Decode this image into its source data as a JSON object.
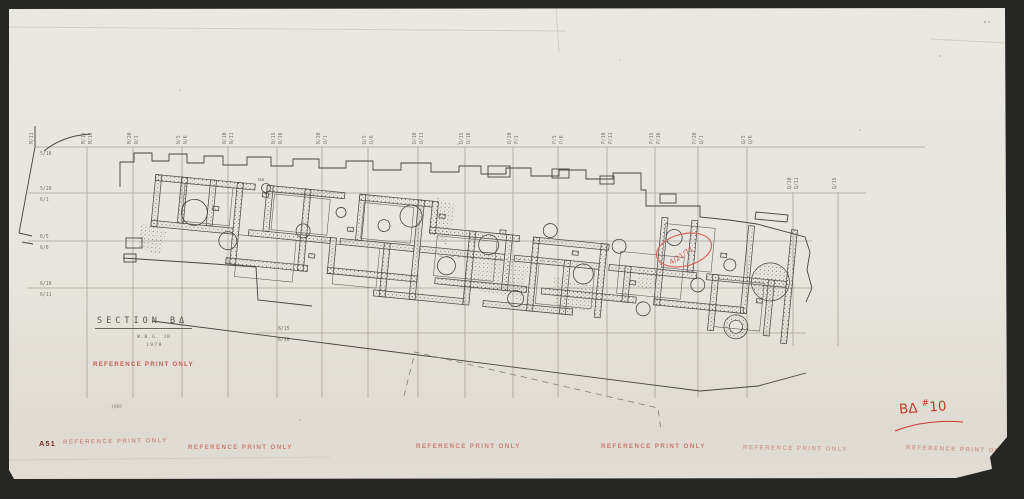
{
  "scan": {
    "background": "#262625",
    "paper_color": "#e9e6e0"
  },
  "grid": {
    "color": "#a8a39a",
    "label_color": "#76726a",
    "edge_column": {
      "x": 35,
      "label": "M/11"
    },
    "columns": [
      {
        "x": 87,
        "labels": [
          "M/15",
          "M/16"
        ]
      },
      {
        "x": 133,
        "labels": [
          "M/20",
          "N/1"
        ]
      },
      {
        "x": 182,
        "labels": [
          "N/5",
          "N/6"
        ]
      },
      {
        "x": 228,
        "labels": [
          "N/10",
          "N/11"
        ]
      },
      {
        "x": 277,
        "labels": [
          "N/15",
          "N/16"
        ]
      },
      {
        "x": 322,
        "labels": [
          "N/20",
          "O/1"
        ]
      },
      {
        "x": 368,
        "labels": [
          "O/5",
          "O/6"
        ]
      },
      {
        "x": 418,
        "labels": [
          "O/10",
          "O/11"
        ]
      },
      {
        "x": 465,
        "labels": [
          "O/15",
          "O/16"
        ]
      },
      {
        "x": 513,
        "labels": [
          "O/20",
          "P/1"
        ]
      },
      {
        "x": 558,
        "labels": [
          "P/5",
          "P/6"
        ]
      },
      {
        "x": 607,
        "labels": [
          "P/10",
          "P/11"
        ]
      },
      {
        "x": 655,
        "labels": [
          "P/15",
          "P/16"
        ]
      },
      {
        "x": 698,
        "labels": [
          "P/20",
          "Q/1"
        ]
      },
      {
        "x": 747,
        "labels": [
          "Q/5",
          "Q/6"
        ]
      },
      {
        "x": 793,
        "labels": [
          "Q/10",
          "Q/11"
        ],
        "short": true
      },
      {
        "x": 838,
        "labels": [
          "Q/15",
          ""
        ],
        "short": true
      }
    ],
    "rows": [
      {
        "y": 147,
        "x1": 35,
        "x2": 925,
        "above": "",
        "below": "5/16",
        "label_x": 40
      },
      {
        "y": 193,
        "x1": 28,
        "x2": 866,
        "above": "5/20",
        "below": "6/1",
        "label_x": 40
      },
      {
        "y": 241,
        "x1": 28,
        "x2": 812,
        "above": "6/5",
        "below": "6/6",
        "label_x": 40
      },
      {
        "y": 288,
        "x1": 28,
        "x2": 812,
        "above": "6/10",
        "below": "6/11",
        "label_x": 40
      },
      {
        "y": 333,
        "x1": 256,
        "x2": 806,
        "above": "6/15",
        "below": "6/16",
        "label_x": 278
      }
    ],
    "col_y1": 147,
    "col_y2": 398,
    "short_y1": 192,
    "short_y2": 346
  },
  "title_block": {
    "title": "SECTION BΔ",
    "author": "W.B.G. JR",
    "year": "1970",
    "stamp": "REFERENCE PRINT ONLY"
  },
  "plan": {
    "tab_label": "TAB",
    "red_note": "4/21/71"
  },
  "stamps": {
    "text": "REFERENCE PRINT ONLY",
    "positions": [
      {
        "x": 63,
        "y": 438,
        "o": 0.55,
        "r": -1
      },
      {
        "x": 188,
        "y": 444,
        "o": 0.7,
        "r": 0
      },
      {
        "x": 416,
        "y": 443,
        "o": 0.7,
        "r": 0
      },
      {
        "x": 601,
        "y": 443,
        "o": 0.75,
        "r": 0
      },
      {
        "x": 743,
        "y": 445,
        "o": 0.45,
        "r": 1
      },
      {
        "x": 906,
        "y": 446,
        "o": 0.5,
        "r": 2
      }
    ]
  },
  "margin_notes": {
    "sheet_number": "A51",
    "pencil_note": "1966",
    "catalog_prefix": "BΔ",
    "catalog_sup": "#",
    "catalog_number": "10"
  }
}
